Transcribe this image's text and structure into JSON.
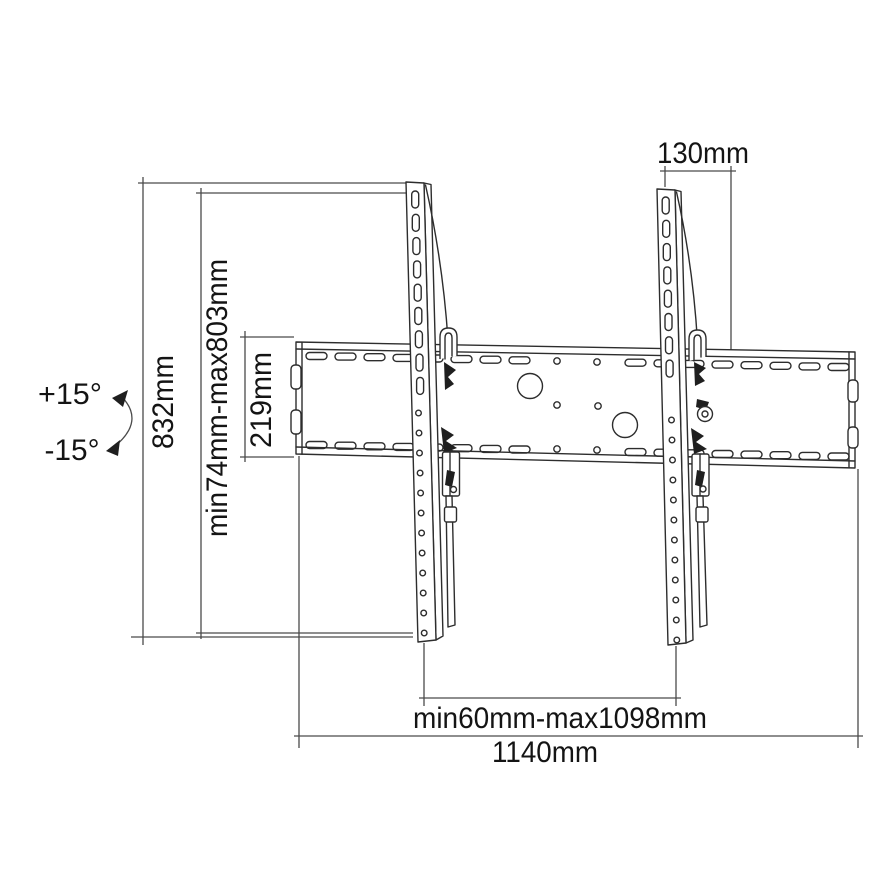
{
  "colors": {
    "background": "#ffffff",
    "line_art": "#2d2d2d",
    "dimension_lines": "#4a4a4a",
    "text": "#141414"
  },
  "dimensions": {
    "tilt_up": "+15°",
    "tilt_down": "-15°",
    "total_height": "832mm",
    "height_range": "min74mm-max803mm",
    "plate_height": "219mm",
    "top_offset": "130mm",
    "width_range": "min60mm-max1098mm",
    "total_width": "1140mm"
  }
}
